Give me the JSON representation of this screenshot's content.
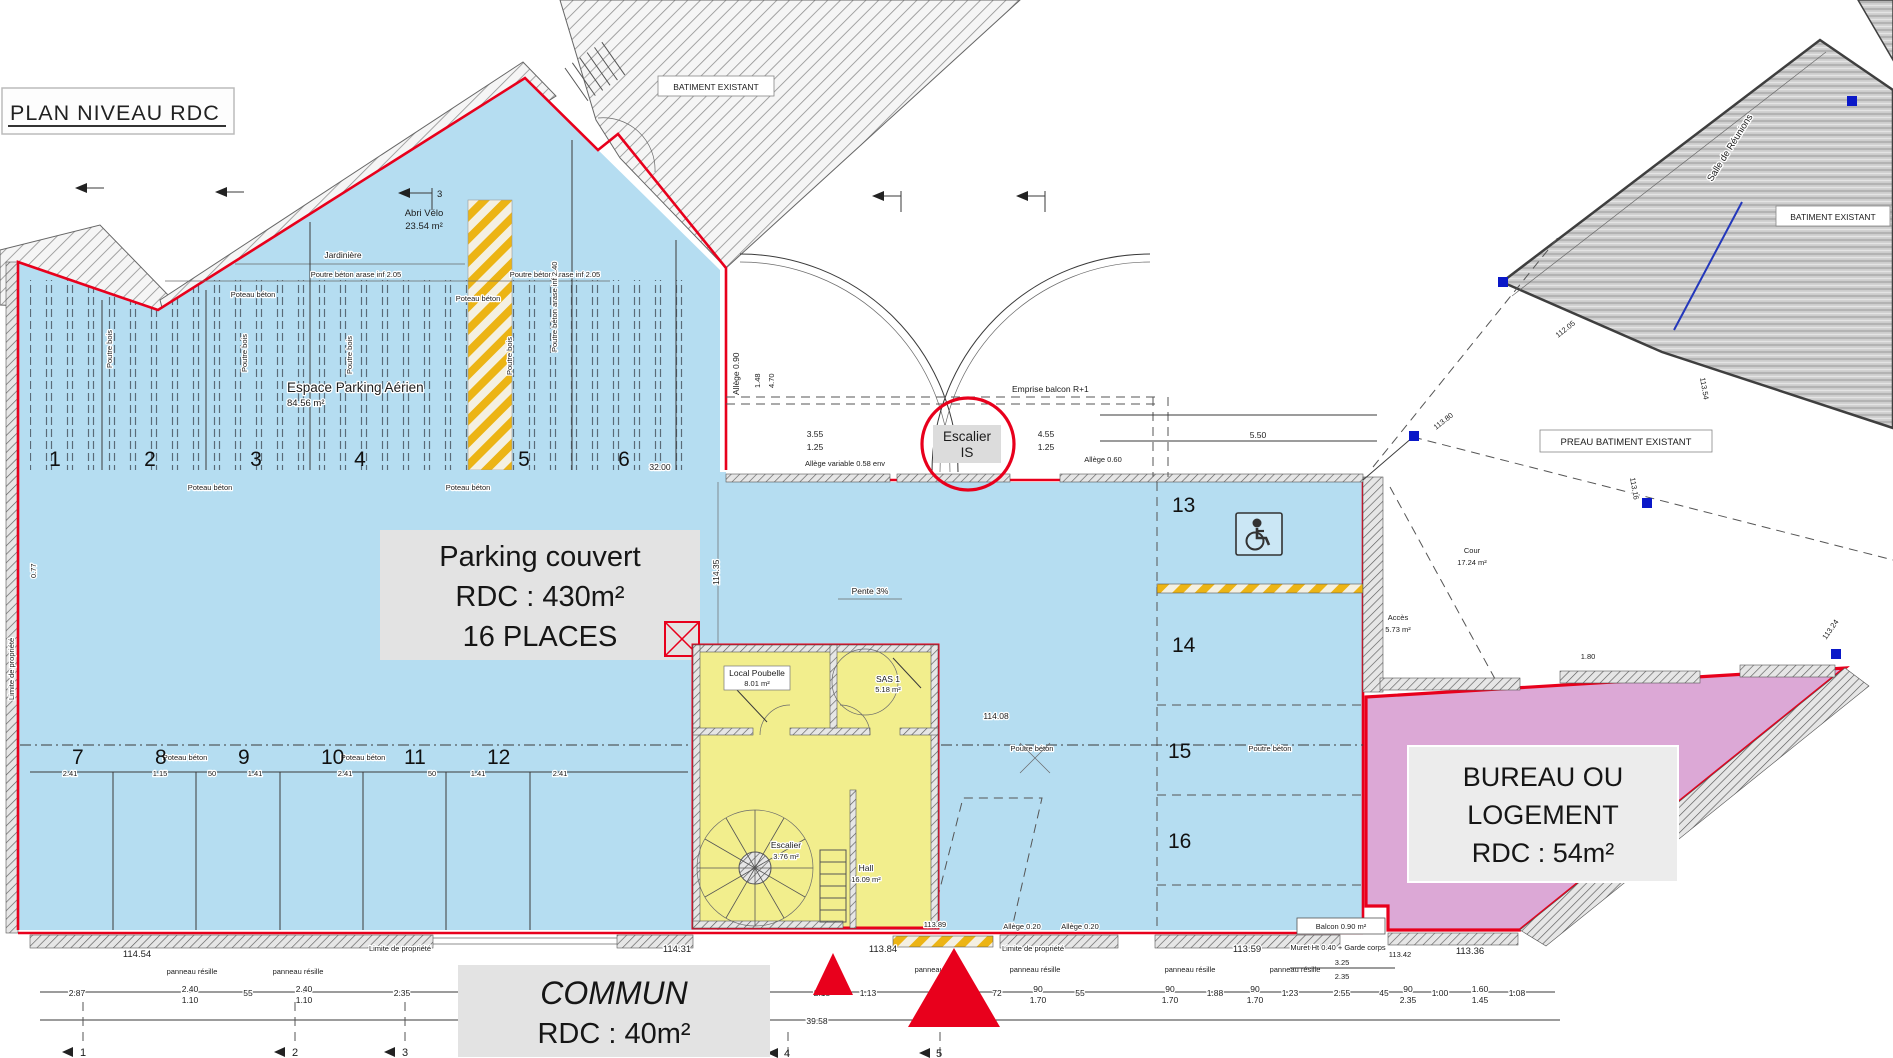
{
  "title": "PLAN NIVEAU RDC",
  "zones": {
    "parking": {
      "l1": "Parking couvert",
      "l2": "RDC : 430m²",
      "l3": "16 PLACES"
    },
    "bureau": {
      "l1": "BUREAU OU",
      "l2": "LOGEMENT",
      "l3": "RDC : 54m²"
    },
    "commun": {
      "l1": "COMMUN",
      "l2": "RDC : 40m²"
    },
    "espace_parking": {
      "l1": "Espace Parking Aérien",
      "l2": "84.56 m²"
    },
    "abri_velo": {
      "l1": "Abri Vélo",
      "l2": "23.54 m²"
    },
    "local_poubelle": {
      "l1": "Local Poubelle",
      "l2": "8.01 m²"
    },
    "sas": {
      "l1": "SAS 1",
      "l2": "5.18 m²"
    },
    "escalier": {
      "l1": "Escalier",
      "l2": "3.76 m²"
    },
    "hall": {
      "l1": "Hall",
      "l2": "16.09 m²"
    },
    "cour": {
      "l1": "Cour",
      "l2": "17.24 m²"
    },
    "acces": {
      "l1": "Accès",
      "l2": "5.73 m²"
    },
    "escalier_is": {
      "l1": "Escalier",
      "l2": "IS"
    },
    "balcon": "Balcon 0.90 m²"
  },
  "buildings": {
    "top": "BATIMENT EXISTANT",
    "right": "BATIMENT EXISTANT",
    "preau": "PREAU BATIMENT EXISTANT",
    "salle": "Salle de Réunions"
  },
  "notes": {
    "jardiniere": "Jardinière",
    "poutre205": "Poutre béton arase inf 2.05",
    "poutre240": "Poutre béton arase inf 2.40",
    "poteau": "Poteau béton",
    "poutre": "Poutre béton",
    "poutre_bois": "Poutre bois",
    "allege090": "Allège 0.90",
    "allege_var": "Allège variable 0.58 env",
    "allege060": "Allège 0.60",
    "allege020": "Allège 0.20",
    "emprise": "Emprise balcon R+1",
    "pente": "Pente 3%",
    "muret": "Muret Ht 0.40 + Garde corps",
    "limite": "Limite de propriété",
    "panneau": "panneau résille"
  },
  "spaces": {
    "s1": "1",
    "s2": "2",
    "s3": "3",
    "s4": "4",
    "s5": "5",
    "s6": "6",
    "s7": "7",
    "s8": "8",
    "s9": "9",
    "s10": "10",
    "s11": "11",
    "s12": "12",
    "s13": "13",
    "s14": "14",
    "s15": "15",
    "s16": "16"
  },
  "levels": {
    "v11454": "114.54",
    "v11431": "114.31",
    "v11384": "113.84",
    "v11359": "113.59",
    "v11342": "113.42",
    "v11336": "113.36",
    "v11389": "113.89",
    "v11380": "113.80",
    "v11205": "112.05",
    "v11354": "113.54",
    "v11316": "113.16",
    "v11324": "113.24",
    "v11435": "114.35",
    "v11408": "114.08"
  },
  "dims": {
    "bl": [
      {
        "a": "2.87"
      },
      {
        "a": "2.40",
        "b": "1.10"
      },
      {
        "a": "55"
      },
      {
        "a": "2.40",
        "b": "1.10"
      },
      {
        "a": "2.35"
      }
    ],
    "br": [
      {
        "a": "2.15"
      },
      {
        "a": "1.13"
      },
      {
        "a": "72"
      },
      {
        "a": "90",
        "b": "1.70"
      },
      {
        "a": "55"
      },
      {
        "a": "90",
        "b": "1.70"
      },
      {
        "a": "1.88"
      },
      {
        "a": "90",
        "b": "1.70"
      },
      {
        "a": "1.23"
      },
      {
        "a": "2.55"
      },
      {
        "a": "45"
      },
      {
        "a": "90",
        "b": "2.35"
      },
      {
        "a": "1.00"
      },
      {
        "a": "1.60",
        "b": "1.45"
      },
      {
        "a": "1.08"
      }
    ],
    "beam": [
      {
        "a": "2.41"
      },
      {
        "a": "1.15"
      },
      {
        "a": "50"
      },
      {
        "a": "1.41"
      },
      {
        "a": "2.41"
      },
      {
        "a": "50"
      },
      {
        "a": "1.41"
      },
      {
        "a": "2.41"
      }
    ],
    "top": [
      {
        "a": "3.55",
        "b": "1.25"
      },
      {
        "a": "4.55",
        "b": "1.25"
      }
    ],
    "total": "39.58",
    "d550": "5.50",
    "d325": "3.25",
    "d235": "2.35",
    "d180": "1.80",
    "d077": "0.77",
    "d3200": "32.00",
    "d148": "1.48",
    "d470": "4.70"
  },
  "axes": {
    "a1": "1",
    "a2": "2",
    "a3": "3",
    "a4": "4",
    "a5": "5",
    "a3top": "3"
  }
}
